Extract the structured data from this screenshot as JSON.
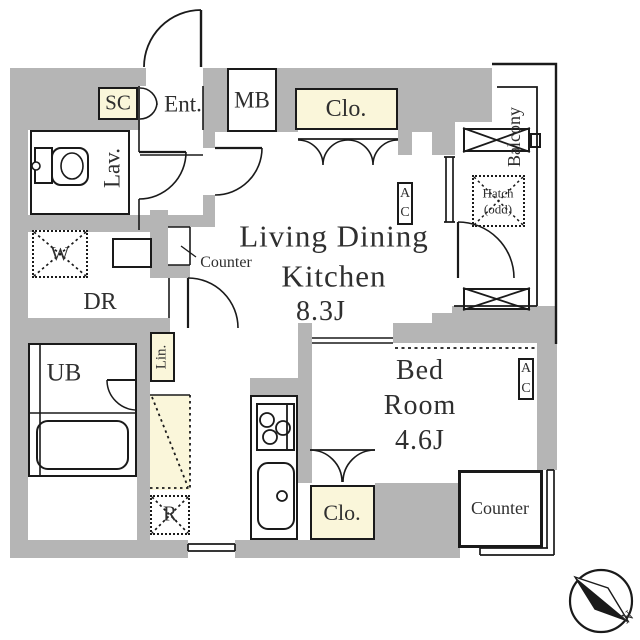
{
  "floorplan": {
    "rooms": {
      "ldk": {
        "line1": "Living Dining",
        "line2": "Kitchen",
        "size": "8.3J"
      },
      "bedroom": {
        "line1": "Bed",
        "line2": "Room",
        "size": "4.6J"
      },
      "lavatory": {
        "label": "Lav."
      },
      "dressing_room": {
        "label": "DR"
      },
      "unit_bath": {
        "label": "UB"
      },
      "entrance": {
        "label": "Ent."
      },
      "balcony": {
        "label": "Balcony"
      }
    },
    "features": {
      "shoe_closet": "SC",
      "meter_box": "MB",
      "closet_upper": "Clo.",
      "closet_lower": "Clo.",
      "linen": "Lin.",
      "washer": "W",
      "refrigerator": "R",
      "hatch": {
        "line1": "Hatch",
        "line2": "(odd)"
      },
      "air_con": {
        "letter1": "A",
        "letter2": "C"
      },
      "counter_ldk": "Counter",
      "counter_bedroom": "Counter"
    },
    "compass": {
      "north": "N"
    },
    "colors": {
      "wall": "#b5b5b5",
      "highlight": "#faf6da",
      "line": "#1a1a1a",
      "text": "#2f2f2f"
    }
  }
}
